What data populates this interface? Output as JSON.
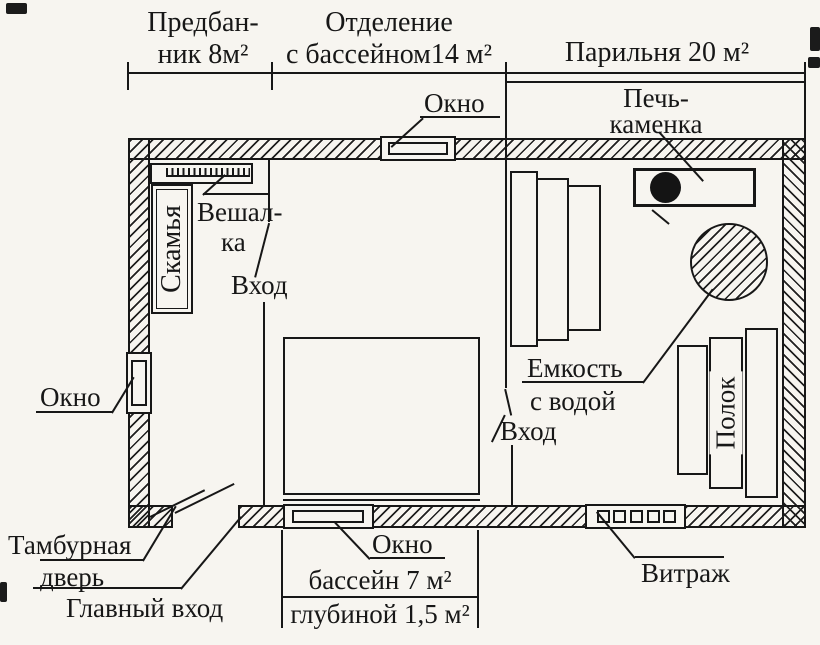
{
  "plan": {
    "sections": [
      {
        "id": "predbannik",
        "line1": "Предбан-",
        "line2": "ник 8м²"
      },
      {
        "id": "otdelenie",
        "line1": "Отделение",
        "line2": "с бассейном14 м²"
      },
      {
        "id": "parilnya",
        "line1": "Парильня 20 м²"
      }
    ],
    "labels": {
      "stove_line1": "Печь-",
      "stove_line2": "каменка",
      "window": "Окно",
      "bench": "Скамья",
      "hanger_line1": "Вешал-",
      "hanger_line2": "ка",
      "entrance": "Вход",
      "tank_line1": "Емкость",
      "tank_line2": "с водой",
      "shelf": "Полок",
      "tambour_line1": "Тамбурная",
      "tambour_line2": "дверь",
      "main_entrance": "Главный вход",
      "pool_area": "бассейн 7 м²",
      "pool_depth": "глубиной 1,5 м²",
      "vitrage": "Витраж"
    },
    "colors": {
      "ink": "#171717",
      "paper": "#f7f5f0"
    }
  }
}
